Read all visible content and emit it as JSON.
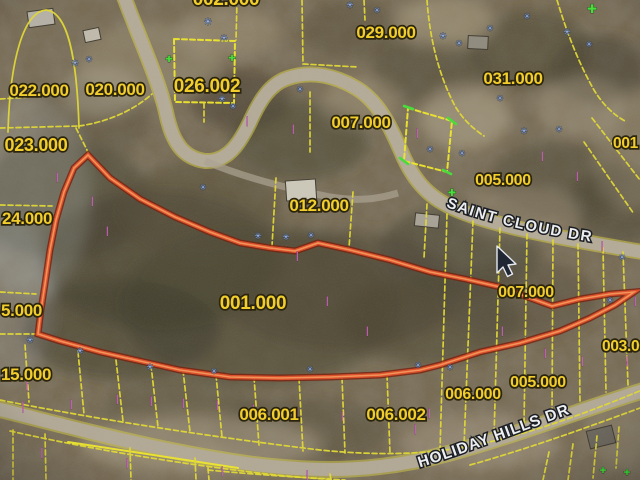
{
  "app": {
    "description": "Aerial GIS parcel map with highlighted parcel"
  },
  "map": {
    "highlighted_parcel_id": "001.000",
    "roads": [
      {
        "name": "SAINT CLOUD DR"
      },
      {
        "name": "HOLIDAY HILLS DR"
      }
    ],
    "labels": [
      {
        "id": "parcel-002.000-clipped-top",
        "text": "002.000"
      },
      {
        "id": "parcel-022.000",
        "text": "022.000"
      },
      {
        "id": "parcel-020.000",
        "text": "020.000"
      },
      {
        "id": "parcel-026.002",
        "text": "026.002"
      },
      {
        "id": "parcel-029.000",
        "text": "029.000"
      },
      {
        "id": "parcel-031.000",
        "text": "031.000"
      },
      {
        "id": "parcel-007.000-north",
        "text": "007.000"
      },
      {
        "id": "parcel-023.000",
        "text": "023.000"
      },
      {
        "id": "parcel-012.000",
        "text": "012.000"
      },
      {
        "id": "parcel-005.000-north",
        "text": "005.000"
      },
      {
        "id": "parcel-001-clipped-right",
        "text": "001"
      },
      {
        "id": "parcel-024.000-clipped-left",
        "text": "24.000"
      },
      {
        "id": "parcel-005.000-clipped-left",
        "text": "5.000"
      },
      {
        "id": "parcel-007.000-east",
        "text": "007.000"
      },
      {
        "id": "parcel-001.000-highlighted",
        "text": "001.000"
      },
      {
        "id": "parcel-015.000-clipped-left",
        "text": "15.000"
      },
      {
        "id": "parcel-003.000-clipped-right",
        "text": "003.000"
      },
      {
        "id": "parcel-006.001",
        "text": "006.001"
      },
      {
        "id": "parcel-006.002",
        "text": "006.002"
      },
      {
        "id": "parcel-006.000",
        "text": "006.000"
      },
      {
        "id": "parcel-005.000-south",
        "text": "005.000"
      }
    ],
    "colors": {
      "parcel_line": "#e6dc25",
      "parcel_label_text": "#fad219",
      "parcel_label_outline": "#221a00",
      "highlight_outline": "#e8491f",
      "highlight_core": "#ff9a55",
      "road_fill": "#b5ab97",
      "road_label_text": "#f2f4f8",
      "marker_blue": "#a9c1f0",
      "marker_pink": "#e87fd8",
      "marker_green": "#39e42c"
    },
    "marker_glyphs": {
      "blue": "✳",
      "pink": "▏",
      "green": "✚"
    },
    "cursor": {
      "x": 497,
      "y": 246
    }
  },
  "markers": [
    {
      "kind": "blue",
      "x": 75,
      "y": 66,
      "s": 9
    },
    {
      "kind": "blue",
      "x": 89,
      "y": 62,
      "s": 8
    },
    {
      "kind": "blue",
      "x": 208,
      "y": 25,
      "s": 10
    },
    {
      "kind": "blue",
      "x": 224,
      "y": 41,
      "s": 9
    },
    {
      "kind": "blue",
      "x": 222,
      "y": 102,
      "s": 9
    },
    {
      "kind": "blue",
      "x": 233,
      "y": 109,
      "s": 8
    },
    {
      "kind": "blue",
      "x": 350,
      "y": 8,
      "s": 9
    },
    {
      "kind": "blue",
      "x": 377,
      "y": 13,
      "s": 8
    },
    {
      "kind": "blue",
      "x": 443,
      "y": 39,
      "s": 9
    },
    {
      "kind": "blue",
      "x": 459,
      "y": 46,
      "s": 8
    },
    {
      "kind": "blue",
      "x": 490,
      "y": 31,
      "s": 8
    },
    {
      "kind": "blue",
      "x": 527,
      "y": 19,
      "s": 8
    },
    {
      "kind": "blue",
      "x": 567,
      "y": 35,
      "s": 9
    },
    {
      "kind": "blue",
      "x": 589,
      "y": 47,
      "s": 8
    },
    {
      "kind": "blue",
      "x": 300,
      "y": 92,
      "s": 8
    },
    {
      "kind": "blue",
      "x": 500,
      "y": 101,
      "s": 8
    },
    {
      "kind": "blue",
      "x": 524,
      "y": 134,
      "s": 9
    },
    {
      "kind": "blue",
      "x": 559,
      "y": 132,
      "s": 8
    },
    {
      "kind": "blue",
      "x": 430,
      "y": 152,
      "s": 8
    },
    {
      "kind": "blue",
      "x": 462,
      "y": 156,
      "s": 8
    },
    {
      "kind": "blue",
      "x": 258,
      "y": 239,
      "s": 9
    },
    {
      "kind": "blue",
      "x": 286,
      "y": 240,
      "s": 9
    },
    {
      "kind": "blue",
      "x": 311,
      "y": 238,
      "s": 8
    },
    {
      "kind": "blue",
      "x": 203,
      "y": 190,
      "s": 8
    },
    {
      "kind": "blue",
      "x": 30,
      "y": 343,
      "s": 9
    },
    {
      "kind": "blue",
      "x": 80,
      "y": 354,
      "s": 9
    },
    {
      "kind": "blue",
      "x": 150,
      "y": 370,
      "s": 9
    },
    {
      "kind": "blue",
      "x": 214,
      "y": 374,
      "s": 8
    },
    {
      "kind": "blue",
      "x": 310,
      "y": 372,
      "s": 8
    },
    {
      "kind": "blue",
      "x": 418,
      "y": 368,
      "s": 8
    },
    {
      "kind": "blue",
      "x": 450,
      "y": 370,
      "s": 8
    },
    {
      "kind": "blue",
      "x": 610,
      "y": 303,
      "s": 8
    },
    {
      "kind": "blue",
      "x": 622,
      "y": 260,
      "s": 8
    },
    {
      "kind": "pink",
      "x": 30,
      "y": 388,
      "s": 9
    },
    {
      "kind": "pink",
      "x": 26,
      "y": 410,
      "s": 9
    },
    {
      "kind": "pink",
      "x": 74,
      "y": 407,
      "s": 8
    },
    {
      "kind": "pink",
      "x": 120,
      "y": 402,
      "s": 8
    },
    {
      "kind": "pink",
      "x": 154,
      "y": 404,
      "s": 8
    },
    {
      "kind": "pink",
      "x": 186,
      "y": 406,
      "s": 8
    },
    {
      "kind": "pink",
      "x": 220,
      "y": 408,
      "s": 8
    },
    {
      "kind": "pink",
      "x": 256,
      "y": 412,
      "s": 8
    },
    {
      "kind": "pink",
      "x": 300,
      "y": 416,
      "s": 8
    },
    {
      "kind": "pink",
      "x": 345,
      "y": 419,
      "s": 8
    },
    {
      "kind": "pink",
      "x": 390,
      "y": 418,
      "s": 8
    },
    {
      "kind": "pink",
      "x": 432,
      "y": 416,
      "s": 8
    },
    {
      "kind": "pink",
      "x": 45,
      "y": 456,
      "s": 9
    },
    {
      "kind": "pink",
      "x": 130,
      "y": 466,
      "s": 8
    },
    {
      "kind": "pink",
      "x": 225,
      "y": 474,
      "s": 8
    },
    {
      "kind": "pink",
      "x": 310,
      "y": 478,
      "s": 8
    },
    {
      "kind": "pink",
      "x": 418,
      "y": 432,
      "s": 8
    },
    {
      "kind": "pink",
      "x": 505,
      "y": 334,
      "s": 8
    },
    {
      "kind": "pink",
      "x": 548,
      "y": 356,
      "s": 8
    },
    {
      "kind": "pink",
      "x": 585,
      "y": 364,
      "s": 8
    },
    {
      "kind": "pink",
      "x": 612,
      "y": 349,
      "s": 8
    },
    {
      "kind": "pink",
      "x": 630,
      "y": 364,
      "s": 8
    },
    {
      "kind": "pink",
      "x": 95,
      "y": 204,
      "s": 8
    },
    {
      "kind": "pink",
      "x": 60,
      "y": 180,
      "s": 8
    },
    {
      "kind": "pink",
      "x": 110,
      "y": 234,
      "s": 8
    },
    {
      "kind": "pink",
      "x": 250,
      "y": 124,
      "s": 8
    },
    {
      "kind": "pink",
      "x": 296,
      "y": 132,
      "s": 8
    },
    {
      "kind": "pink",
      "x": 420,
      "y": 136,
      "s": 8
    },
    {
      "kind": "pink",
      "x": 545,
      "y": 159,
      "s": 8
    },
    {
      "kind": "pink",
      "x": 580,
      "y": 179,
      "s": 8
    },
    {
      "kind": "pink",
      "x": 300,
      "y": 259,
      "s": 8
    },
    {
      "kind": "pink",
      "x": 330,
      "y": 304,
      "s": 8
    },
    {
      "kind": "pink",
      "x": 370,
      "y": 334,
      "s": 8
    },
    {
      "kind": "pink",
      "x": 605,
      "y": 249,
      "s": 8
    },
    {
      "kind": "pink",
      "x": 18,
      "y": 374,
      "s": 8
    },
    {
      "kind": "pink",
      "x": 638,
      "y": 304,
      "s": 8
    },
    {
      "kind": "green",
      "x": 592,
      "y": 13,
      "s": 12
    },
    {
      "kind": "green",
      "x": 169,
      "y": 62,
      "s": 9
    },
    {
      "kind": "green",
      "x": 232,
      "y": 61,
      "s": 9
    },
    {
      "kind": "green",
      "x": 452,
      "y": 196,
      "s": 10
    },
    {
      "kind": "green",
      "x": 603,
      "y": 473,
      "s": 8
    },
    {
      "kind": "green",
      "x": 627,
      "y": 475,
      "s": 8
    }
  ]
}
